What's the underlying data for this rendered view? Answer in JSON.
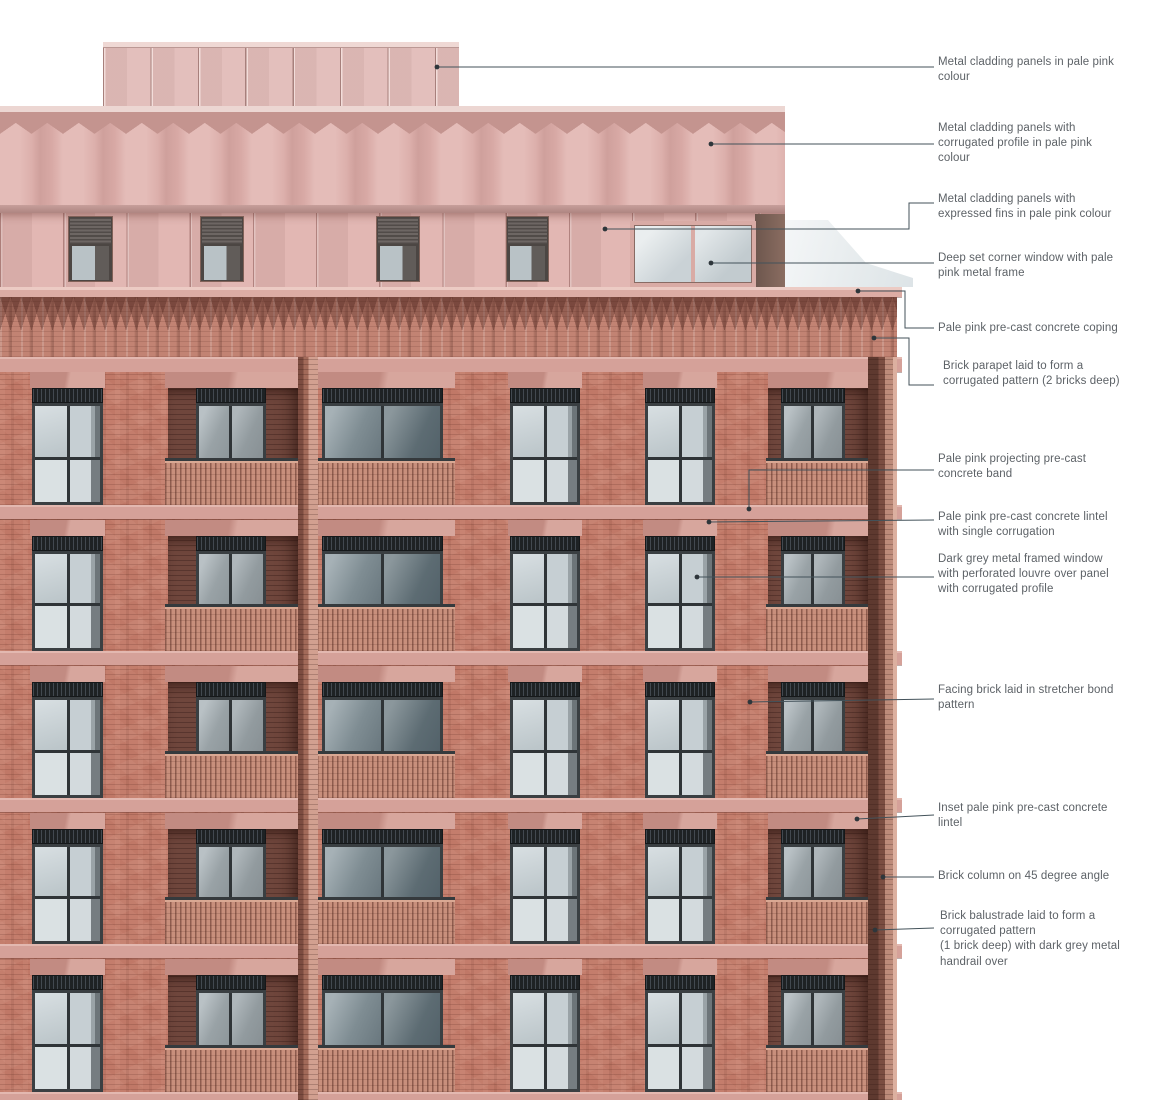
{
  "drawing": {
    "type": "annotated building elevation",
    "subject": "Residential facade with brick lower storeys and pale pink metal-clad upper storeys"
  },
  "annotations": [
    {
      "id": "cladding-plain",
      "lines": [
        "Metal cladding panels in pale pink",
        "colour"
      ]
    },
    {
      "id": "cladding-corrugated",
      "lines": [
        "Metal cladding panels with",
        "corrugated profile in pale pink",
        "colour"
      ]
    },
    {
      "id": "cladding-fins",
      "lines": [
        "Metal cladding panels with",
        "expressed fins in pale pink colour"
      ]
    },
    {
      "id": "corner-window",
      "lines": [
        "Deep set corner window with pale",
        "pink metal frame"
      ]
    },
    {
      "id": "coping",
      "lines": [
        "Pale pink pre-cast concrete coping"
      ]
    },
    {
      "id": "parapet",
      "lines": [
        "Brick parapet laid to form a",
        "corrugated pattern (2 bricks deep)"
      ]
    },
    {
      "id": "concrete-band",
      "lines": [
        "Pale pink projecting pre-cast",
        "concrete band"
      ]
    },
    {
      "id": "lintel-corrugation",
      "lines": [
        "Pale pink pre-cast concrete lintel",
        "with single corrugation"
      ]
    },
    {
      "id": "window-louvre",
      "lines": [
        "Dark grey metal framed window",
        "with perforated louvre over panel",
        "with corrugated profile"
      ]
    },
    {
      "id": "facing-brick",
      "lines": [
        "Facing brick laid in stretcher bond",
        "pattern"
      ]
    },
    {
      "id": "inset-lintel",
      "lines": [
        "Inset pale pink pre-cast concrete",
        "lintel"
      ]
    },
    {
      "id": "brick-column",
      "lines": [
        "Brick column on 45 degree angle"
      ]
    },
    {
      "id": "balustrade",
      "lines": [
        "Brick balustrade laid to form a",
        "corrugated pattern",
        "(1 brick deep) with dark grey metal",
        "handrail over"
      ]
    }
  ],
  "colors": {
    "facing_brick": "#c47d6c",
    "pale_pink_cladding": "#e2bab6",
    "precast_band": "#d5a199",
    "window_frame_dark_grey": "#383d40",
    "balcony_recess": "#6f463c",
    "leader_line": "#43525a",
    "annotation_text": "#5d6267"
  }
}
